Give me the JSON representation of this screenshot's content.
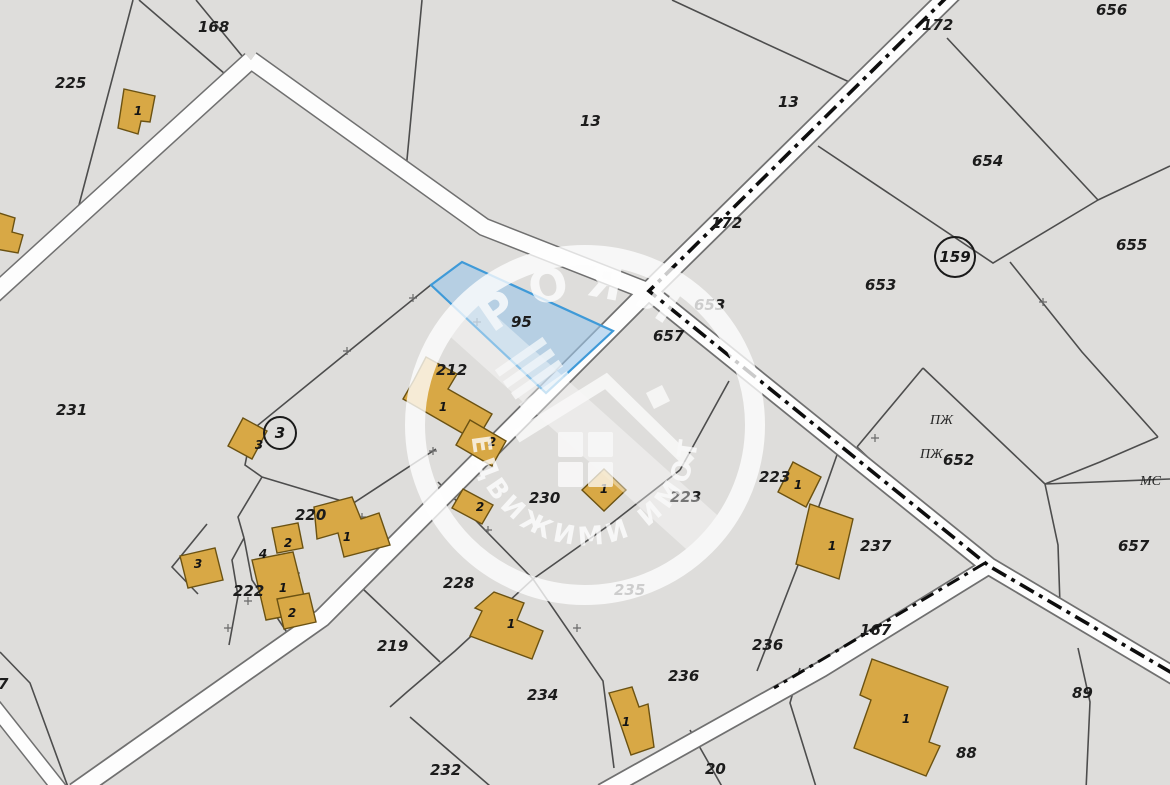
{
  "map": {
    "type": "cadastral-map",
    "colors": {
      "background": "#dedddb",
      "road_fill": "#fdfdfd",
      "road_edge": "#707070",
      "boundary": "#4d4d4d",
      "building_fill": "#d8a845",
      "building_stroke": "#6b5212",
      "highlight_fill": "#9ec7e8",
      "highlight_stroke": "#3f9ad8",
      "watermark": "#ffffff"
    },
    "highlighted_parcel": "95",
    "watermark": {
      "brand_top": "РОЯЛ",
      "brand_bottom": "НЕДВИЖИМИ ИМОТИ",
      "logo": "house-icon"
    },
    "parcel_labels": [
      "168",
      "225",
      "13",
      "13",
      "172",
      "172",
      "656",
      "654",
      "655",
      "653",
      "653",
      "657",
      "95",
      "231",
      "212",
      "652",
      "657",
      "223",
      "223",
      "237",
      "220",
      "222",
      "228",
      "230",
      "235",
      "219",
      "234",
      "236",
      "236",
      "232",
      "20",
      "167",
      "89",
      "88",
      "7"
    ],
    "zone_labels": [
      "ПЖ",
      "ПЖ",
      "МС"
    ],
    "control_points": [
      "159",
      "3"
    ],
    "building_labels": [
      "1",
      "1",
      "2",
      "2",
      "3",
      "1",
      "1",
      "1",
      "3",
      "2",
      "4",
      "1",
      "1",
      "2",
      "1",
      "1",
      "1"
    ]
  }
}
